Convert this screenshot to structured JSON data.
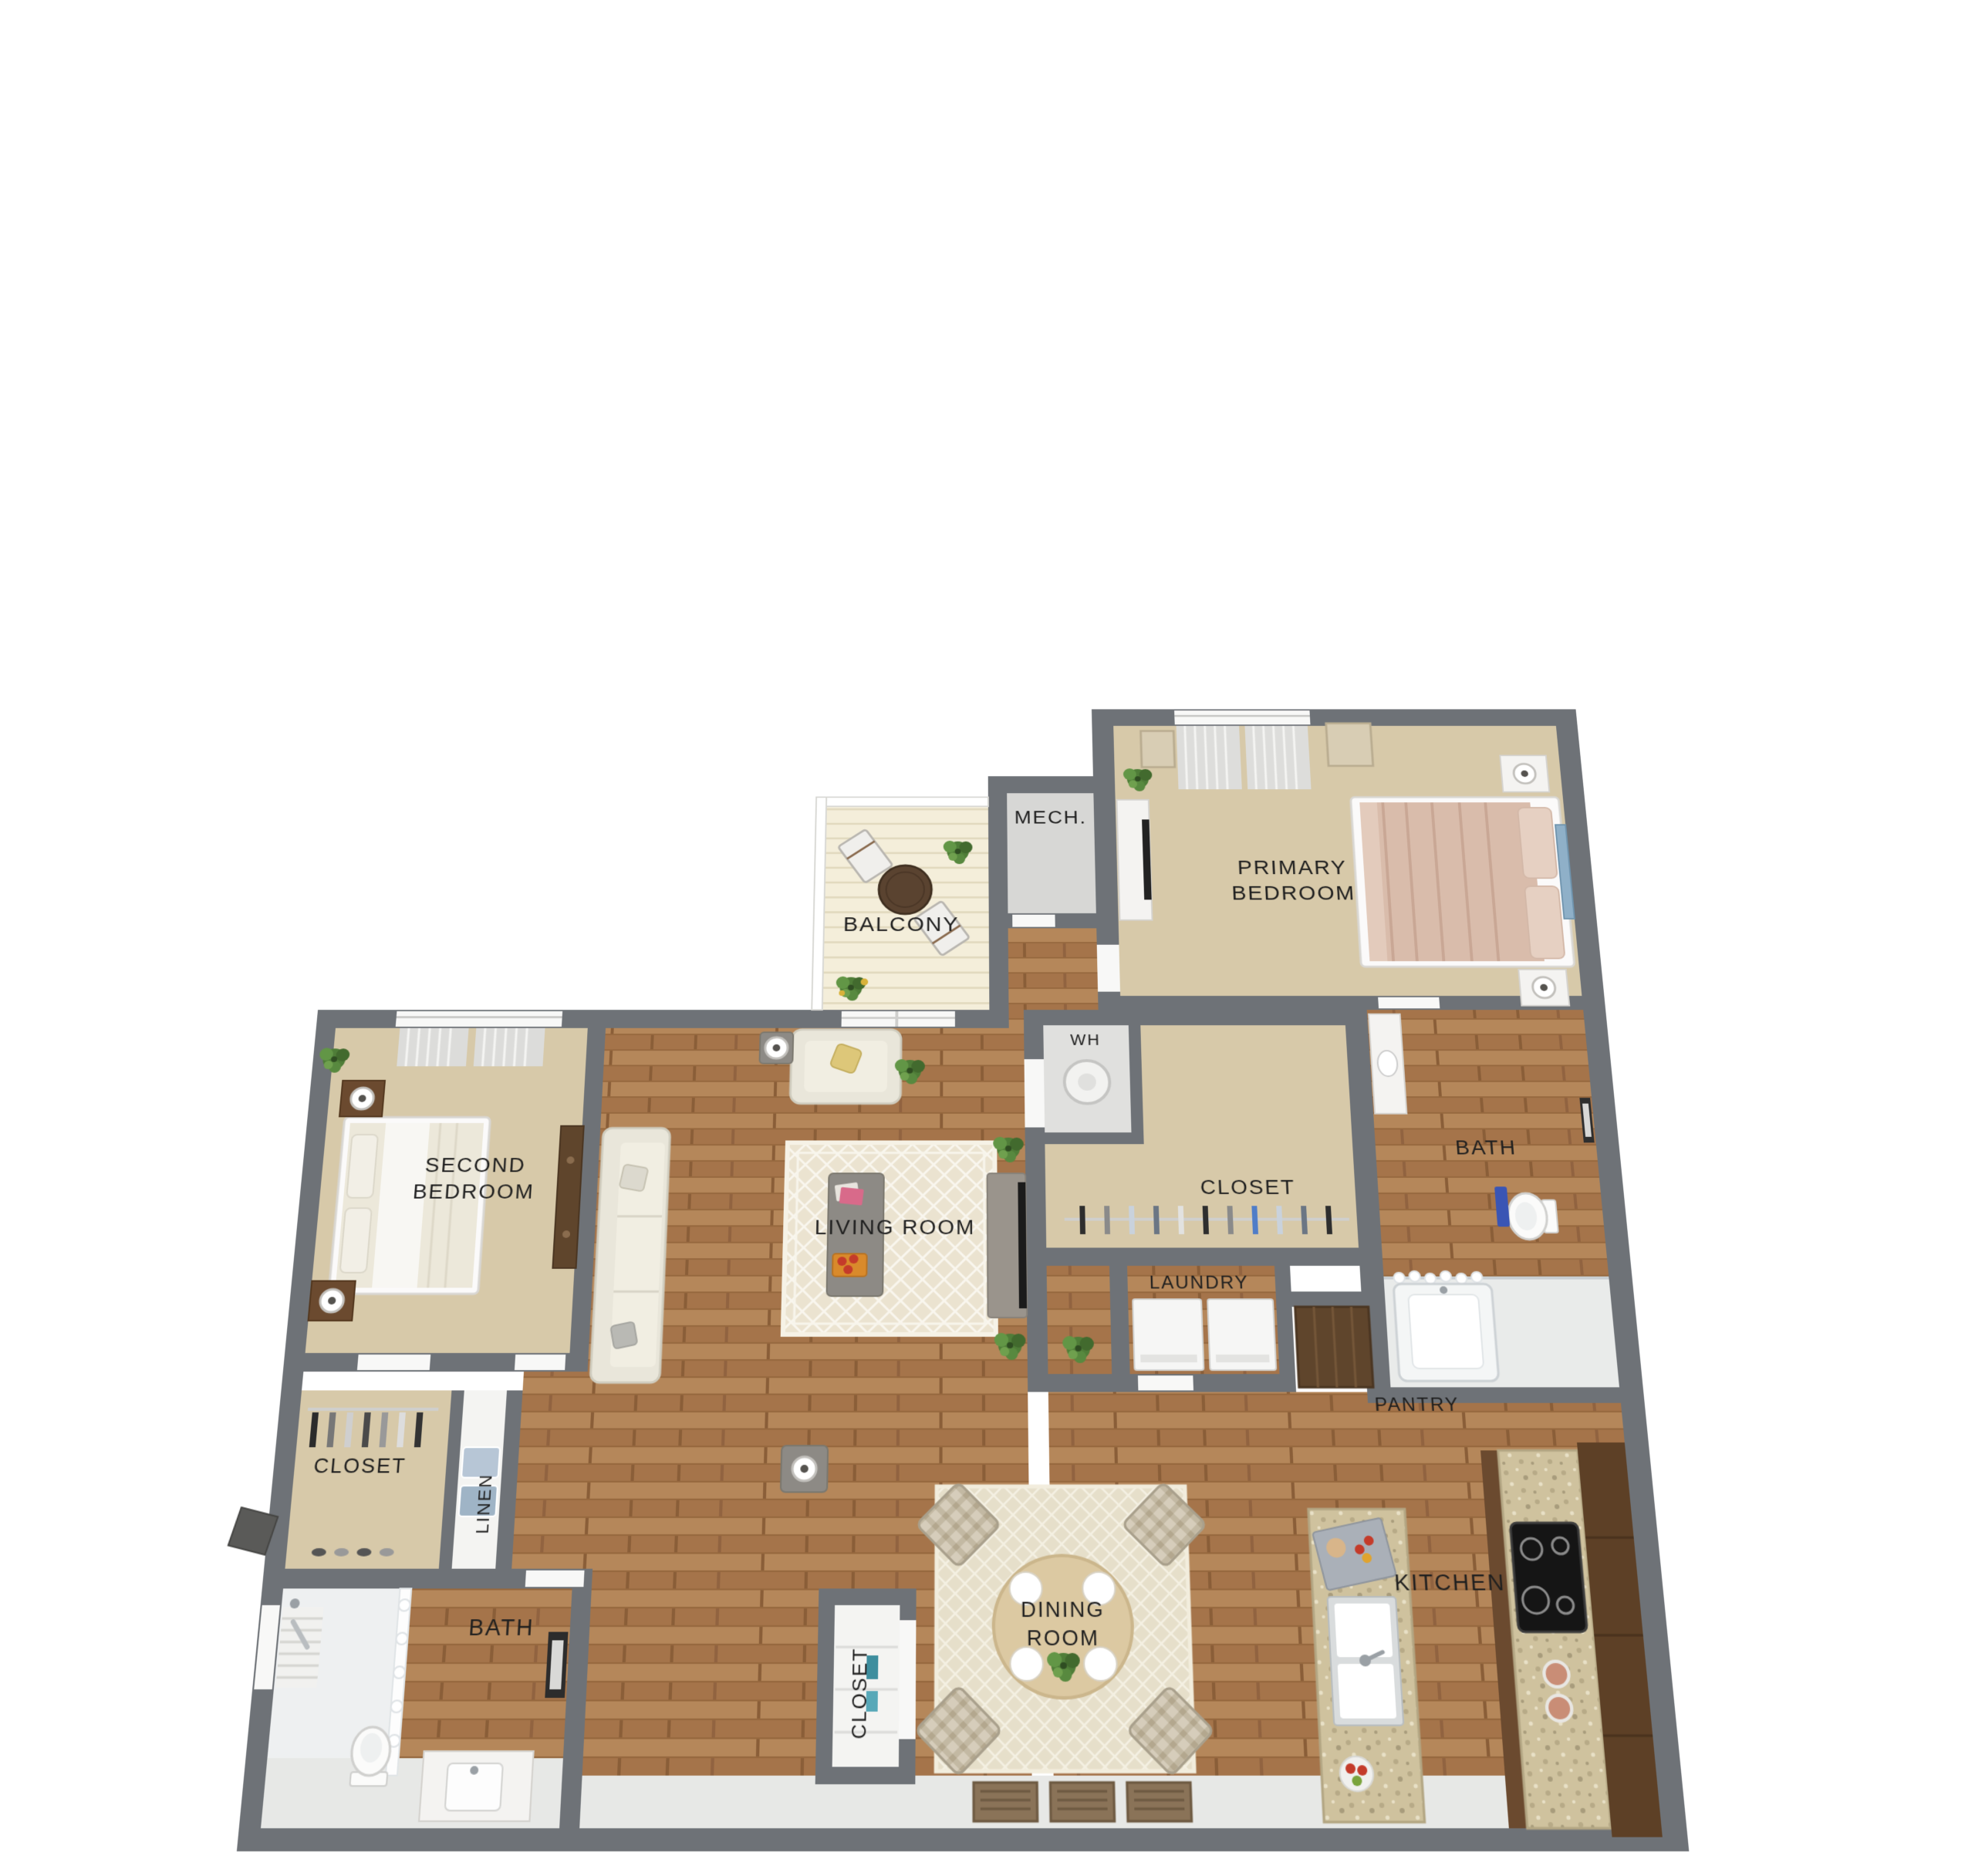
{
  "rooms": [
    {
      "id": "mech",
      "label": "MECH."
    },
    {
      "id": "balcony",
      "label": "BALCONY"
    },
    {
      "id": "primary-bedroom",
      "lines": [
        "PRIMARY",
        "BEDROOM"
      ]
    },
    {
      "id": "water-heater",
      "label": "WH"
    },
    {
      "id": "primary-closet",
      "label": "CLOSET"
    },
    {
      "id": "primary-bath",
      "label": "BATH"
    },
    {
      "id": "laundry",
      "label": "LAUNDRY"
    },
    {
      "id": "pantry",
      "label": "PANTRY"
    },
    {
      "id": "second-bedroom",
      "lines": [
        "SECOND",
        "BEDROOM"
      ]
    },
    {
      "id": "living-room",
      "label": "LIVING ROOM"
    },
    {
      "id": "second-closet",
      "label": "CLOSET"
    },
    {
      "id": "linen",
      "label": "LINEN"
    },
    {
      "id": "second-bath",
      "label": "BATH"
    },
    {
      "id": "entry-closet",
      "label": "CLOSET"
    },
    {
      "id": "dining-room",
      "lines": [
        "DINING",
        "ROOM"
      ]
    },
    {
      "id": "kitchen",
      "label": "KITCHEN"
    }
  ],
  "colors": {
    "wall": "#6e7277",
    "carpet": "#d7c9a9",
    "wood": "#ad7b4e",
    "wood_dark": "#8a5e38",
    "tile": "#e7e8e6",
    "deck": "#f4eeda",
    "granite": "#cfc29e",
    "label_text": "#1f1f1f",
    "towel_blue": "#3a55b4",
    "plant_green": "#4f7d38",
    "bed_tan": "#d9bcab",
    "pantry_brown": "#5f452c",
    "rug_cream": "#ebe3d0"
  }
}
